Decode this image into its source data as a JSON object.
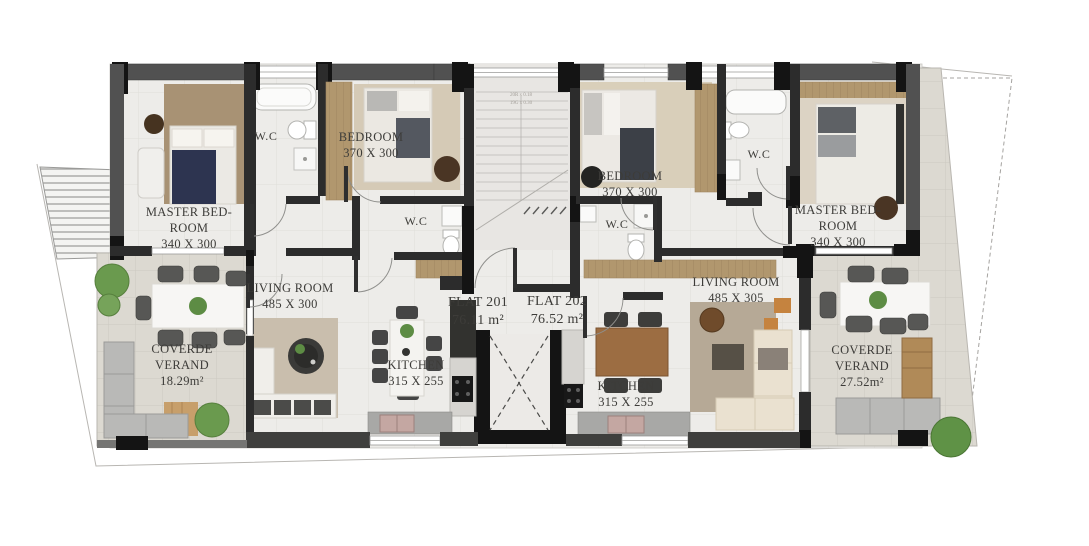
{
  "flats": {
    "flat201": {
      "name": "FLAT 201",
      "area": "76.11 m²"
    },
    "flat202": {
      "name": "FLAT 202",
      "area": "76.52 m²"
    }
  },
  "rooms": {
    "f201_master": {
      "name1": "MASTER BED-",
      "name2": "ROOM",
      "dims": "340 X 300"
    },
    "f201_bedroom": {
      "name": "BEDROOM",
      "dims": "370 X 300"
    },
    "f201_wc_top": {
      "name": "W.C"
    },
    "f201_wc_mid": {
      "name": "W.C"
    },
    "f201_living": {
      "name": "LIVING ROOM",
      "dims": "485 X 300"
    },
    "f201_kitchen": {
      "name": "KITCHEN",
      "dims": "315 X 255"
    },
    "f201_veranda": {
      "name1": "COVERDE",
      "name2": "VERAND",
      "area": "18.29m²"
    },
    "f202_bedroom": {
      "name": "BEDROOM",
      "dims": "370 X 300"
    },
    "f202_wc_top": {
      "name": "W.C"
    },
    "f202_wc_mid": {
      "name": "W.C"
    },
    "f202_master": {
      "name1": "MASTER BED-",
      "name2": "ROOM",
      "dims": "340 X 300"
    },
    "f202_living": {
      "name": "LIVING ROOM",
      "dims": "485 X 305"
    },
    "f202_kitchen": {
      "name": "KITCHEN",
      "dims": "315 X 255"
    },
    "f202_veranda": {
      "name1": "COVERDE",
      "name2": "VERAND",
      "area": "27.52m²"
    }
  },
  "stairs": {
    "note1": "20R x 0.18",
    "note2": "19G x 0.30"
  },
  "palette": {
    "wall": "#515151",
    "wall_dark": "#141414",
    "wood_accent": "#b1976e",
    "floor": "#edece9",
    "veranda_floor": "#dcd9d1",
    "plant": "#6a9a4e",
    "navy_bed": "#2d3450",
    "rug": "#cfc3ad"
  }
}
